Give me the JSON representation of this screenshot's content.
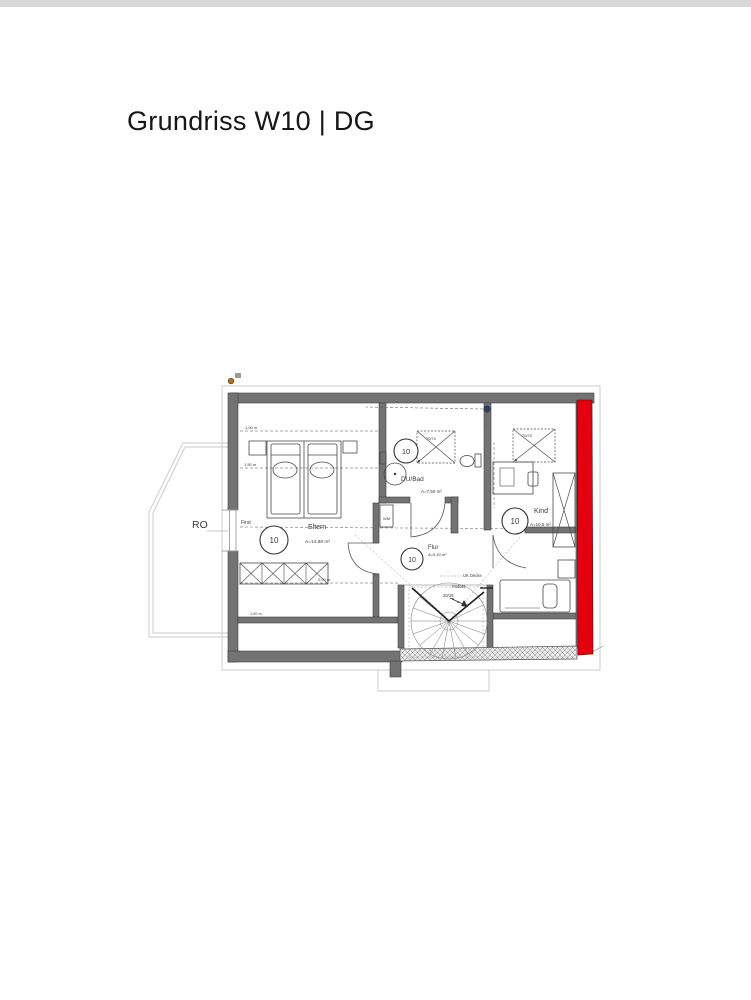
{
  "header": {
    "title": "Grundriss W10 | DG"
  },
  "floorplan": {
    "rooms": [
      {
        "name": "Eltern",
        "area": "A=14,88 m²",
        "unit": "10"
      },
      {
        "name": "DU/Bad",
        "area": "A=7,50 m²",
        "unit": "10"
      },
      {
        "name": "Kind",
        "area": "A=10,5 m²",
        "unit": "10"
      },
      {
        "name": "Flur",
        "area": "A=5,40 m²",
        "unit": "10"
      }
    ],
    "labels": {
      "roof_window": "RO",
      "ridge": "First",
      "height_1_00": "1,00 m",
      "height_1_50": "1,50 m",
      "height_2_00": "2,00 m",
      "height_1_00_bottom": "1,00 m",
      "washing_machine": "WM",
      "shower_size": "70/70",
      "skylight_size": "70/70",
      "ceiling_edge": "UK Decke",
      "landing": "Podest",
      "stair_step": "20/19"
    },
    "colors": {
      "highlight_wall": "#e3000f",
      "wall_gray": "#737373"
    }
  }
}
